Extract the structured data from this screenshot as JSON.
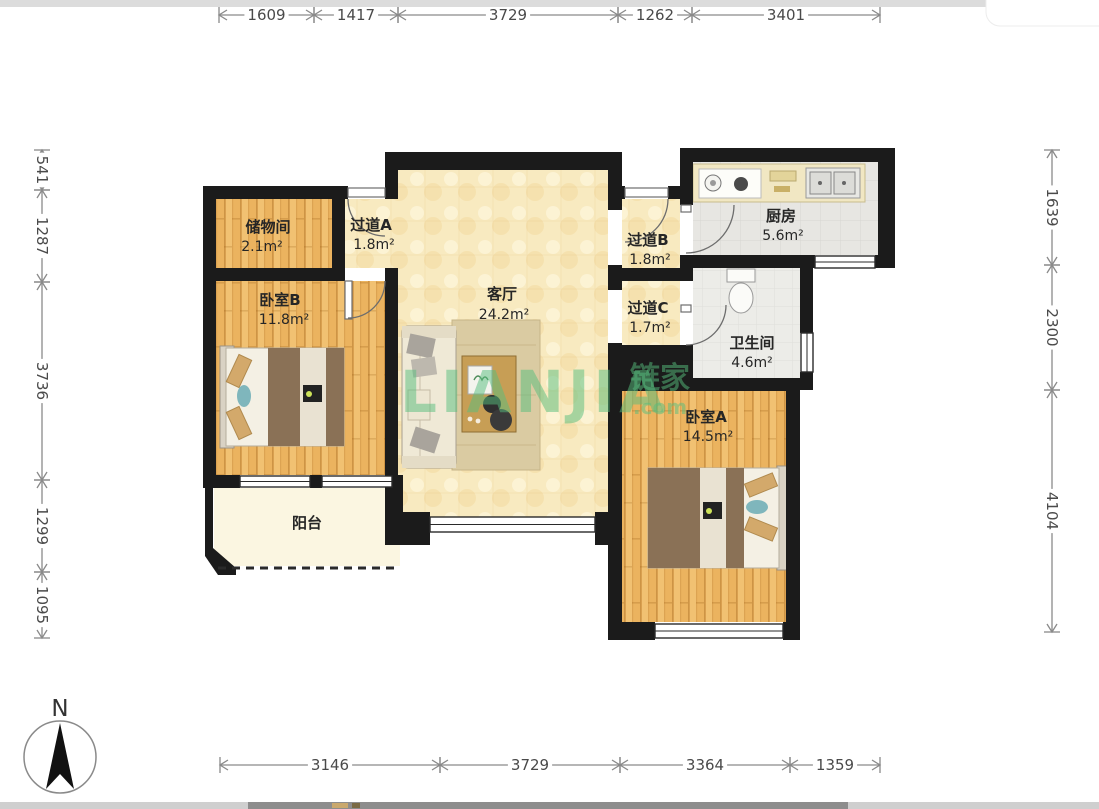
{
  "compass": {
    "label": "N"
  },
  "watermark": {
    "brand": "LIANJIA",
    "domain": ".com",
    "cn": "链家"
  },
  "rooms": {
    "storage": {
      "name": "储物间",
      "area": "2.1m²"
    },
    "hallway_a": {
      "name": "过道A",
      "area": "1.8m²"
    },
    "living": {
      "name": "客厅",
      "area": "24.2m²"
    },
    "hallway_b": {
      "name": "过道B",
      "area": "1.8m²"
    },
    "kitchen": {
      "name": "厨房",
      "area": "5.6m²"
    },
    "hallway_c": {
      "name": "过道C",
      "area": "1.7m²"
    },
    "bathroom": {
      "name": "卫生间",
      "area": "4.6m²"
    },
    "bedroom_b": {
      "name": "卧室B",
      "area": "11.8m²"
    },
    "bedroom_a": {
      "name": "卧室A",
      "area": "14.5m²"
    },
    "balcony": {
      "name": "阳台",
      "area": ""
    }
  },
  "dimensions": {
    "top": [
      "1609",
      "1417",
      "3729",
      "1262",
      "3401"
    ],
    "bottom": [
      "3146",
      "3729",
      "3364",
      "1359"
    ],
    "left": [
      "541",
      "1287",
      "3736",
      "1299",
      "1095"
    ],
    "right": [
      "1639",
      "2300",
      "4104"
    ]
  },
  "colors": {
    "wall": "#1b1b1b",
    "wood_floor": "#EBB35F",
    "cream_floor": "#F8EAC0",
    "tile_floor": "#E7E6E2",
    "watermark_green": "#57BE7E"
  }
}
